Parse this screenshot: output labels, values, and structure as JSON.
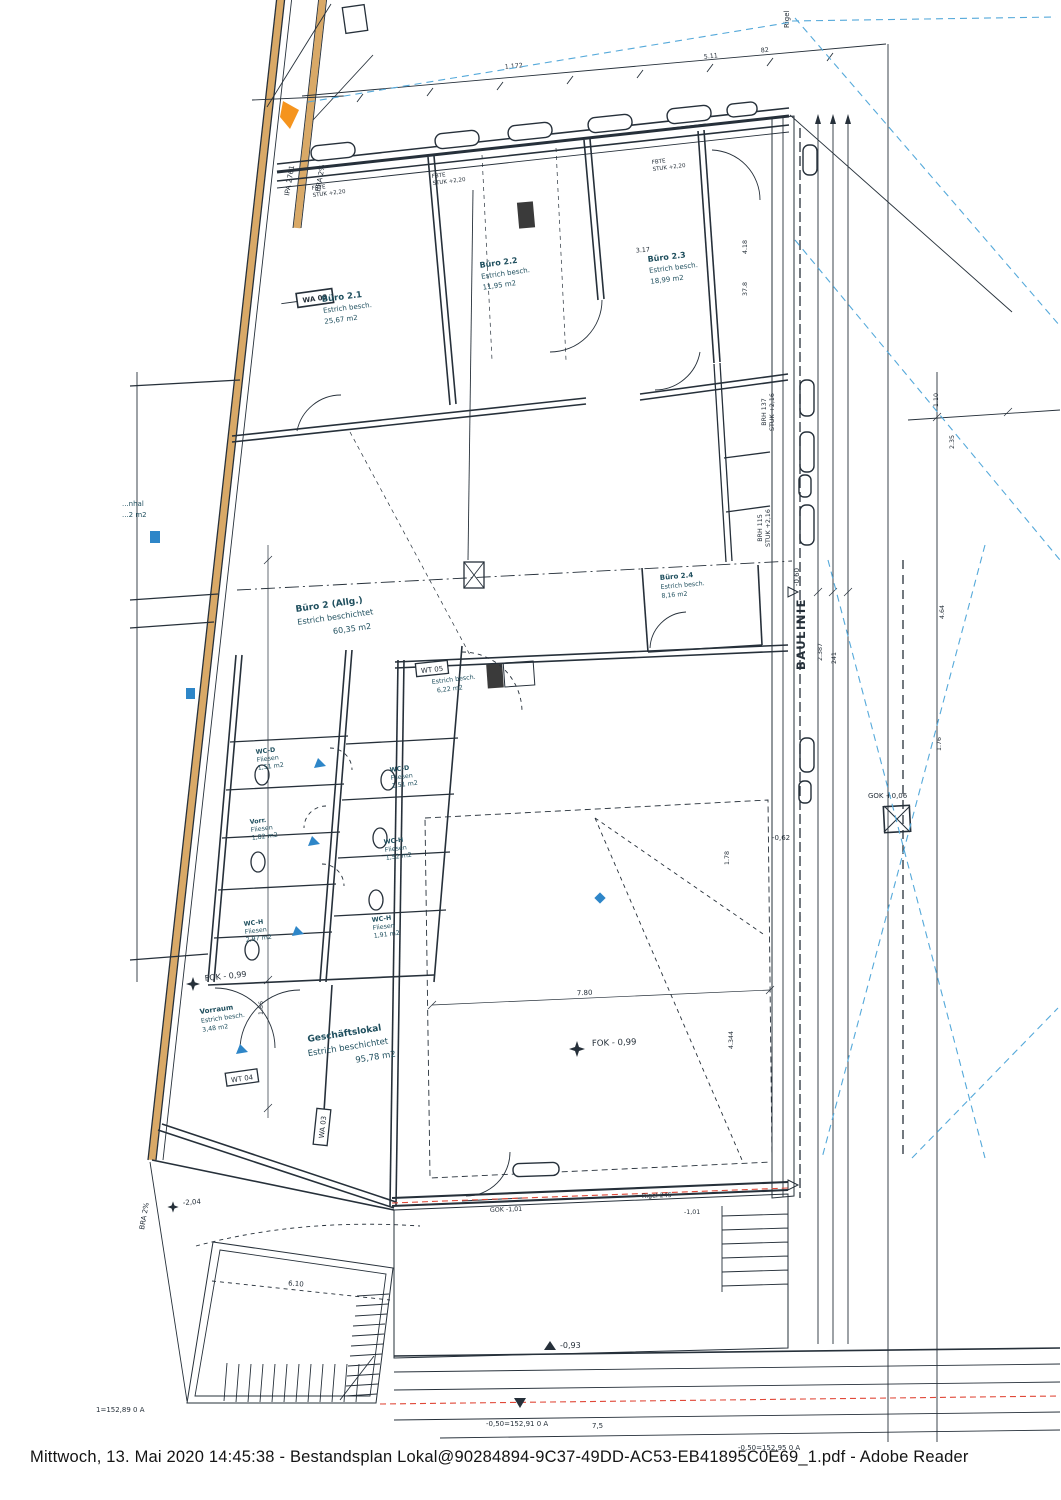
{
  "page": {
    "footer": "Mittwoch, 13. Mai 2020 14:45:38 - Bestandsplan Lokal@90284894-9C37-49DD-AC53-EB41895C0E69_1.pdf - Adobe Reader"
  },
  "colors": {
    "ink": "#26303a",
    "room_label": "#1f4f5e",
    "blue_dash": "#55a9da",
    "red_dash": "#e04838",
    "facade_tan": "#d9a967",
    "orange_marker": "#f5941e",
    "ramp_fill": "#e4e7a3",
    "sidewalk_fill": "#d2d5d1",
    "fixture_blue": "#2e86c8"
  },
  "rooms": {
    "buro21": {
      "name": "Büro 2.1",
      "finish": "Estrich besch.",
      "area": "25,67 m2"
    },
    "buro22": {
      "name": "Büro 2.2",
      "finish": "Estrich besch.",
      "area": "11,95 m2"
    },
    "buro23": {
      "name": "Büro 2.3",
      "finish": "Estrich besch.",
      "area": "18,99 m2"
    },
    "buro2allg": {
      "name": "Büro 2 (Allg.)",
      "finish": "Estrich beschichtet",
      "area": "60,35 m2"
    },
    "buro24": {
      "name": "Büro 2.4",
      "finish": "Estrich besch.",
      "area": "8,16 m2"
    },
    "abstell": {
      "finish": "Estrich besch.",
      "area": "6,22 m2"
    },
    "vorraum": {
      "name": "Vorraum",
      "finish": "Estrich besch.",
      "area": "3,48 m2"
    },
    "geschaeft": {
      "name": "Geschäftslokal",
      "finish": "Estrich beschichtet",
      "area": "95,78 m2"
    },
    "wc_d1": {
      "name": "WC-D",
      "finish": "Fliesen",
      "area": "1,51 m2"
    },
    "wc_d2": {
      "name": "WC-D",
      "finish": "Fliesen",
      "area": "1,51 m2"
    },
    "vorr": {
      "name": "Vorr.",
      "finish": "Fliesen",
      "area": "1,82 m2"
    },
    "wc_h1": {
      "name": "WC-H",
      "finish": "Fliesen",
      "area": "1,52 m2"
    },
    "wc_h2": {
      "name": "WC-H",
      "finish": "Fliesen",
      "area": "2,97 m2"
    },
    "wc_h3": {
      "name": "WC-H",
      "finish": "Fliesen",
      "area": "1,91 m2"
    }
  },
  "annotations": {
    "baulinie": "BAULINIE",
    "rigel_top": "Rigel",
    "fok_vorraum": "FOK - 0,99",
    "fok_lokal": "FOK - 0,99",
    "wa03_top": "WA 03",
    "wt05": "WT 05",
    "wt04": "WT 04",
    "wa03_bottom": "WA 03",
    "ipa": "IPA 2761",
    "bra_top": "BRA 2%",
    "bra_bottom": "BRA 2%",
    "fbte1": "FBTE",
    "stuk1": "STUK +2,20",
    "fbte2": "FBTE",
    "stuk2": "STUK +2,20",
    "fbte3": "FBTE",
    "stuk3": "STUK +2,20",
    "brh137": "BRH 137",
    "stuk216a": "STUK +2,16",
    "brh115": "BRH 115",
    "stuk216b": "STUK +2,16",
    "minus060": "-0,60",
    "minus062": "-0,62",
    "gok006": "GOK +0,06",
    "gok101": "GOK -1,01",
    "rigel245": "Rigel 245",
    "minus101": "-1,01",
    "minus093": "-0,93",
    "minus204": "-2,04",
    "level_left": "1=152,89 0 A",
    "level_mid": "-0,50=152,91 0 A",
    "level_mid_dim": "7,5",
    "level_right": "-0,50=152,95 0 A",
    "cut_label_1": "...nhal",
    "cut_label_2": "...2 m2"
  },
  "dims": {
    "d1": "1.172",
    "d2": "5.11",
    "d3": "82",
    "d4": "3.17",
    "d5": "4.18",
    "d6": "37.8",
    "d7": "2.387",
    "d8": "241",
    "d9": "1.10",
    "d10": "2.35",
    "d11": "4.64",
    "d12": "1.76",
    "d13": "7.80",
    "d14": "4.344",
    "d15": "1.78",
    "d16": "6.10",
    "d17": "1.86"
  }
}
